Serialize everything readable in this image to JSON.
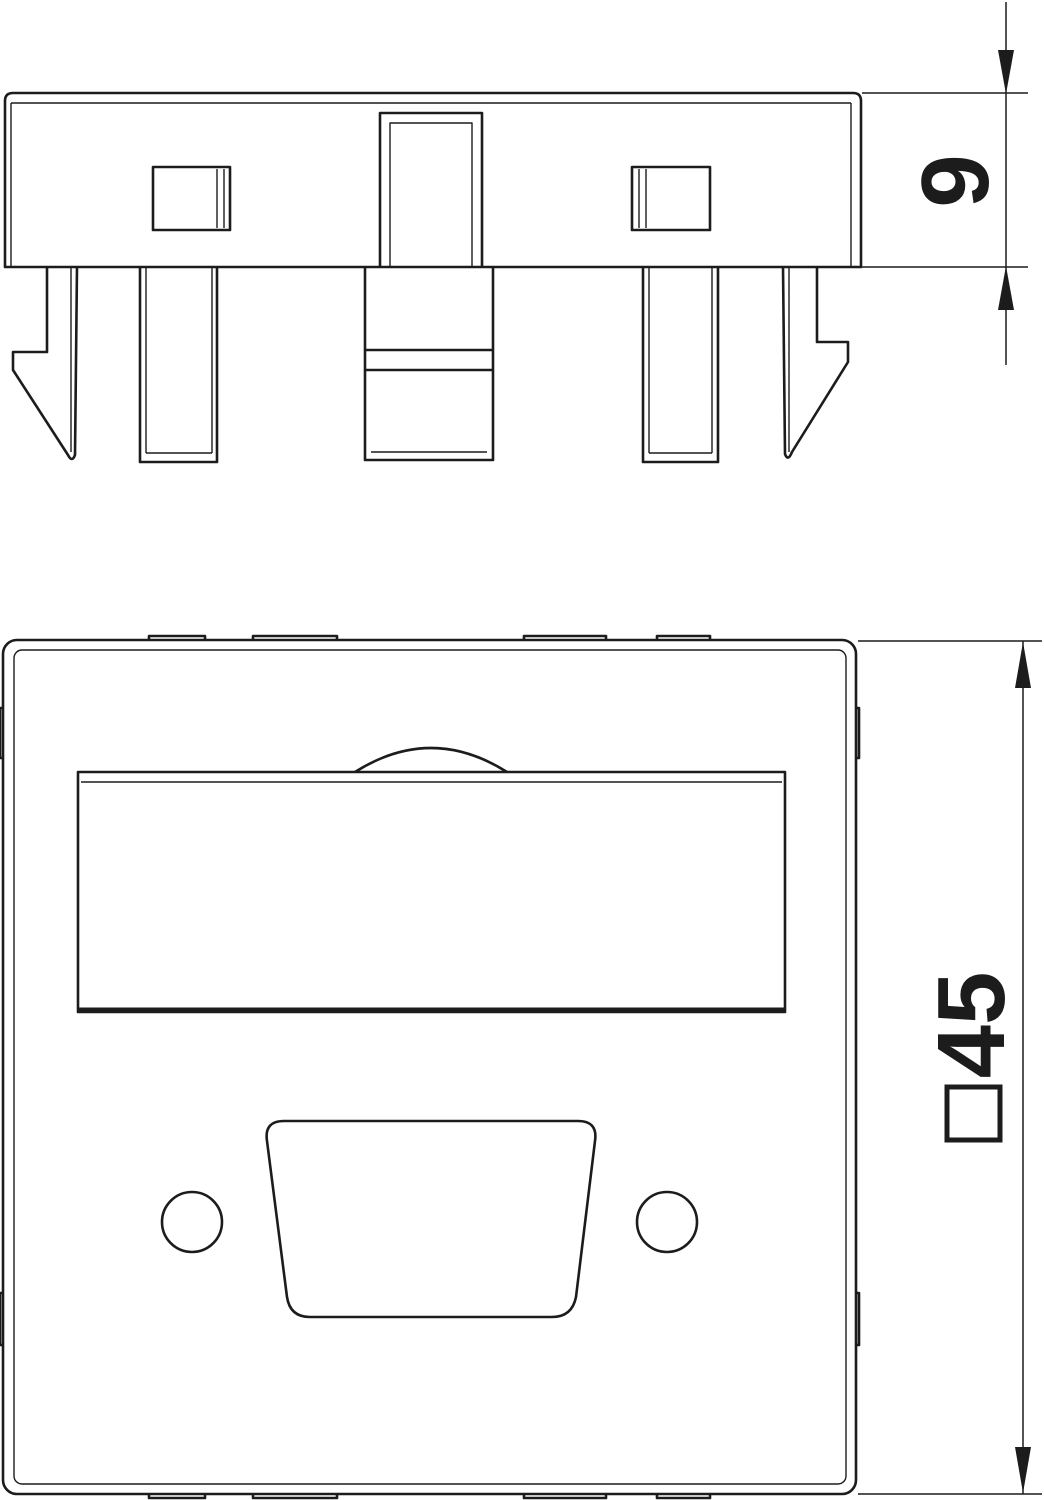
{
  "page": {
    "background": "#ffffff",
    "line_color": "#1c1c1c",
    "description_labels": []
  },
  "side_view": {
    "dimension": {
      "value": "9",
      "full_label": "9",
      "orientation": "rotated-90-ccw"
    }
  },
  "front_view": {
    "dimension": {
      "value": "45",
      "prefix_symbol": "square",
      "full_label": "□45",
      "orientation": "rotated-90-ccw"
    }
  }
}
